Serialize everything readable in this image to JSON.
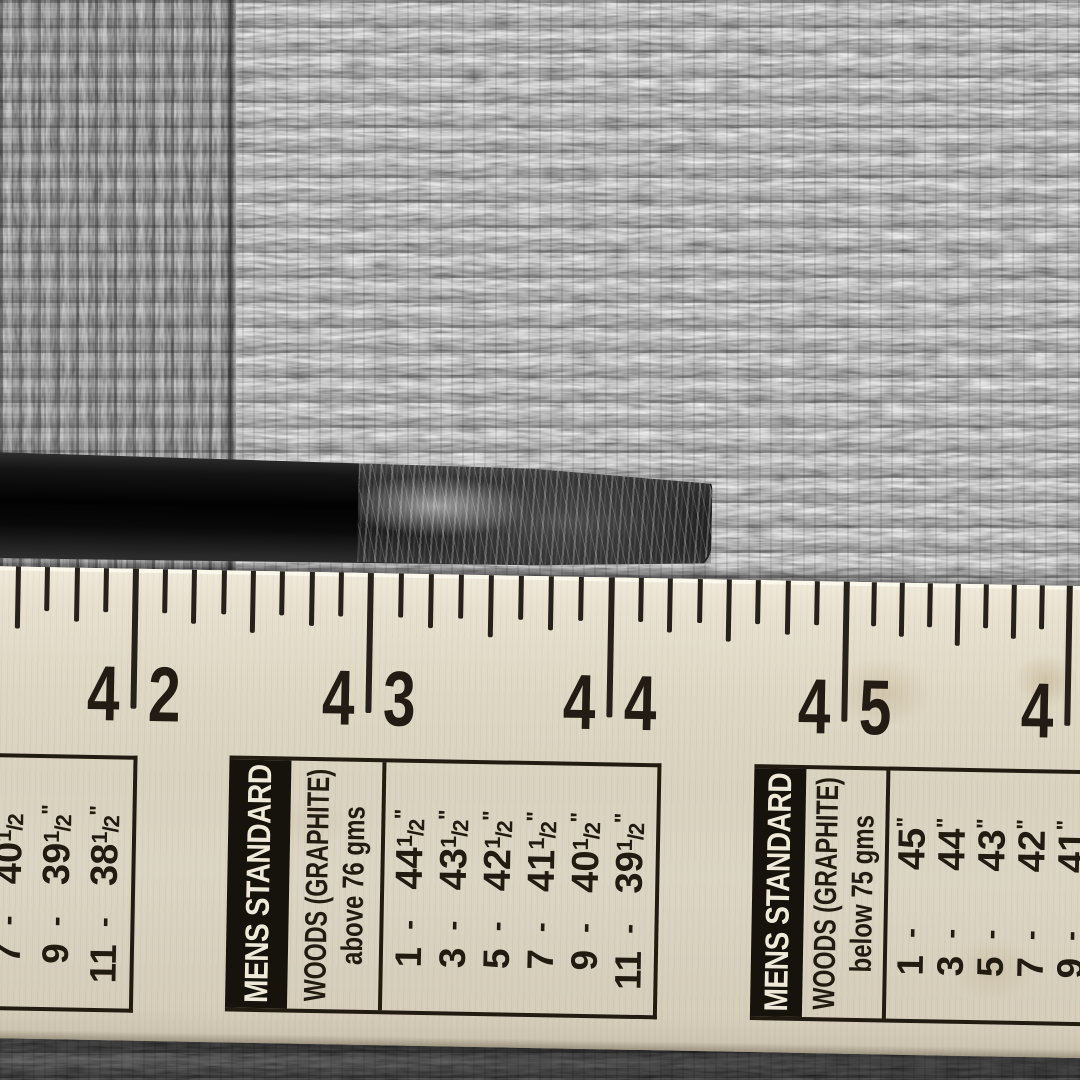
{
  "colors": {
    "ruler_face": "#dcd5c2",
    "ink": "#211b12",
    "banner_bg": "#16120c",
    "banner_text": "#efe9d8",
    "carpet_mid": "#989898",
    "shaft_black": "#0d0d0d",
    "scuff_gray": "#b8b8b8"
  },
  "ruler": {
    "ticks_per_inch": 8,
    "inch_marks": [
      {
        "label": "42",
        "left": "4",
        "right": "2",
        "x": 148
      },
      {
        "label": "43",
        "left": "4",
        "right": "3",
        "x": 383
      },
      {
        "label": "44",
        "left": "4",
        "right": "4",
        "x": 624
      },
      {
        "label": "45",
        "left": "4",
        "right": "5",
        "x": 859
      },
      {
        "label": "46",
        "left": "4",
        "right": "6",
        "x": 1082
      }
    ]
  },
  "tables": {
    "sep": "-",
    "left": {
      "banner": "",
      "header_line1": "",
      "header_line2": "",
      "rows": [
        {
          "club": "7",
          "len": "40",
          "frac_top": "1",
          "frac_slash": "/",
          "frac_bot": "2",
          "unit": "\""
        },
        {
          "club": "9",
          "len": "39",
          "frac_top": "1",
          "frac_slash": "/",
          "frac_bot": "2",
          "unit": "\""
        },
        {
          "club": "11",
          "len": "38",
          "frac_top": "1",
          "frac_slash": "/",
          "frac_bot": "2",
          "unit": "\""
        }
      ]
    },
    "middle": {
      "banner": "MENS STANDARD",
      "header_line1": "WOODS (GRAPHITE)",
      "header_line2": "above 76 gms",
      "rows": [
        {
          "club": "1",
          "len": "44",
          "frac_top": "1",
          "frac_slash": "/",
          "frac_bot": "2",
          "unit": "\""
        },
        {
          "club": "3",
          "len": "43",
          "frac_top": "1",
          "frac_slash": "/",
          "frac_bot": "2",
          "unit": "\""
        },
        {
          "club": "5",
          "len": "42",
          "frac_top": "1",
          "frac_slash": "/",
          "frac_bot": "2",
          "unit": "\""
        },
        {
          "club": "7",
          "len": "41",
          "frac_top": "1",
          "frac_slash": "/",
          "frac_bot": "2",
          "unit": "\""
        },
        {
          "club": "9",
          "len": "40",
          "frac_top": "1",
          "frac_slash": "/",
          "frac_bot": "2",
          "unit": "\""
        },
        {
          "club": "11",
          "len": "39",
          "frac_top": "1",
          "frac_slash": "/",
          "frac_bot": "2",
          "unit": "\""
        }
      ]
    },
    "right": {
      "banner": "MENS STANDARD",
      "header_line1": "WOODS (GRAPHITE)",
      "header_line2": "below 75 gms",
      "rows": [
        {
          "club": "1",
          "len": "45",
          "frac_top": "",
          "frac_slash": "",
          "frac_bot": "",
          "unit": "\""
        },
        {
          "club": "3",
          "len": "44",
          "frac_top": "",
          "frac_slash": "",
          "frac_bot": "",
          "unit": "\""
        },
        {
          "club": "5",
          "len": "43",
          "frac_top": "",
          "frac_slash": "",
          "frac_bot": "",
          "unit": "\""
        },
        {
          "club": "7",
          "len": "42",
          "frac_top": "",
          "frac_slash": "",
          "frac_bot": "",
          "unit": "\""
        },
        {
          "club": "9",
          "len": "41",
          "frac_top": "",
          "frac_slash": "",
          "frac_bot": "",
          "unit": "\""
        }
      ]
    }
  }
}
